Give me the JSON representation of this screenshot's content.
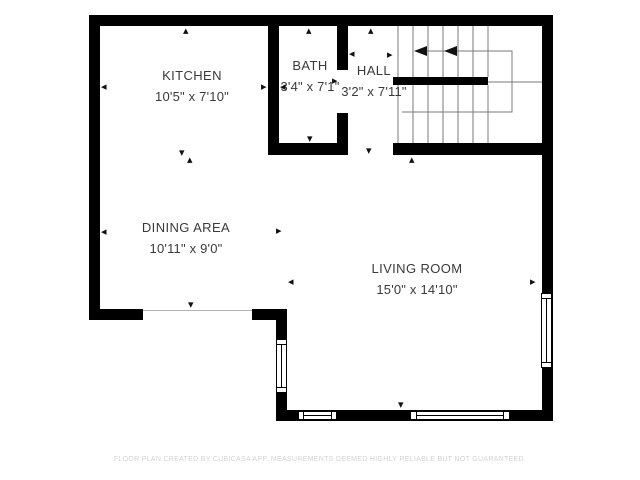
{
  "plan": {
    "rooms": {
      "kitchen": {
        "name": "KITCHEN",
        "dims": "10'5\" x 7'10\""
      },
      "bath": {
        "name": "BATH",
        "dims": "3'4\" x 7'1\""
      },
      "hall": {
        "name": "HALL",
        "dims": "3'2\" x 7'11\""
      },
      "dining": {
        "name": "DINING AREA",
        "dims": "10'11\" x 9'0\""
      },
      "living": {
        "name": "LIVING ROOM",
        "dims": "15'0\" x 14'10\""
      }
    },
    "footer": "FLOOR PLAN CREATED BY CUBICASA APP. MEASUREMENTS DEEMED HIGHLY RELIABLE BUT NOT GUARANTEED.",
    "colors": {
      "wall": "#000000",
      "room_text": "#3a3a3a",
      "stair_tread": "#7a7a7a",
      "footer_text": "#d2d2d2"
    },
    "markers": [
      {
        "room": "kitchen",
        "dir": "up",
        "x": 183,
        "y": 27
      },
      {
        "room": "kitchen",
        "dir": "left",
        "x": 101,
        "y": 83
      },
      {
        "room": "kitchen",
        "dir": "right",
        "x": 261,
        "y": 83
      },
      {
        "room": "kitchen",
        "dir": "down",
        "x": 179,
        "y": 149
      },
      {
        "room": "dining",
        "dir": "up",
        "x": 187,
        "y": 156
      },
      {
        "room": "dining",
        "dir": "left",
        "x": 101,
        "y": 228
      },
      {
        "room": "dining",
        "dir": "right",
        "x": 276,
        "y": 227
      },
      {
        "room": "dining",
        "dir": "down",
        "x": 188,
        "y": 301
      },
      {
        "room": "bath",
        "dir": "up",
        "x": 306,
        "y": 27
      },
      {
        "room": "bath",
        "dir": "left",
        "x": 280,
        "y": 83
      },
      {
        "room": "bath",
        "dir": "right",
        "x": 332,
        "y": 77
      },
      {
        "room": "bath",
        "dir": "down",
        "x": 307,
        "y": 135
      },
      {
        "room": "hall",
        "dir": "up",
        "x": 368,
        "y": 27
      },
      {
        "room": "hall",
        "dir": "left",
        "x": 349,
        "y": 50
      },
      {
        "room": "hall",
        "dir": "right",
        "x": 387,
        "y": 51
      },
      {
        "room": "hall",
        "dir": "down",
        "x": 366,
        "y": 147
      },
      {
        "room": "living",
        "dir": "up",
        "x": 409,
        "y": 156
      },
      {
        "room": "living",
        "dir": "left",
        "x": 288,
        "y": 278
      },
      {
        "room": "living",
        "dir": "right",
        "x": 530,
        "y": 278
      },
      {
        "room": "living",
        "dir": "down",
        "x": 398,
        "y": 401
      }
    ]
  }
}
